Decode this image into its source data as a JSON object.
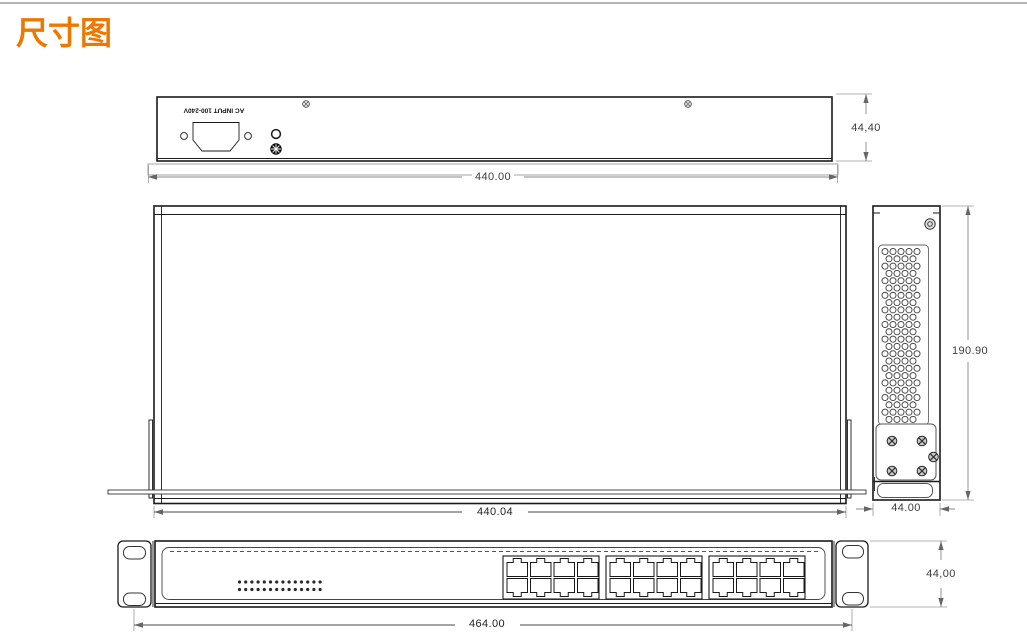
{
  "page": {
    "title": "尺寸图"
  },
  "colors": {
    "accent": "#ee7700",
    "outline": "#1a1a1a",
    "dim_line": "#8a8a8a"
  },
  "icons": {
    "screw": "screw-icon",
    "ground": "ground-terminal-icon",
    "vent": "vent-hole",
    "led": "led-dot"
  },
  "views": {
    "rear": {
      "ac_label": "AC INPUT 100-240V",
      "dim_width": "440.00",
      "dim_height": "44,40"
    },
    "top": {
      "dim_width": "440.04"
    },
    "side": {
      "dim_height": "190.90",
      "dim_depth": "44.00"
    },
    "front": {
      "dim_width": "464.00",
      "dim_height": "44,00"
    }
  }
}
